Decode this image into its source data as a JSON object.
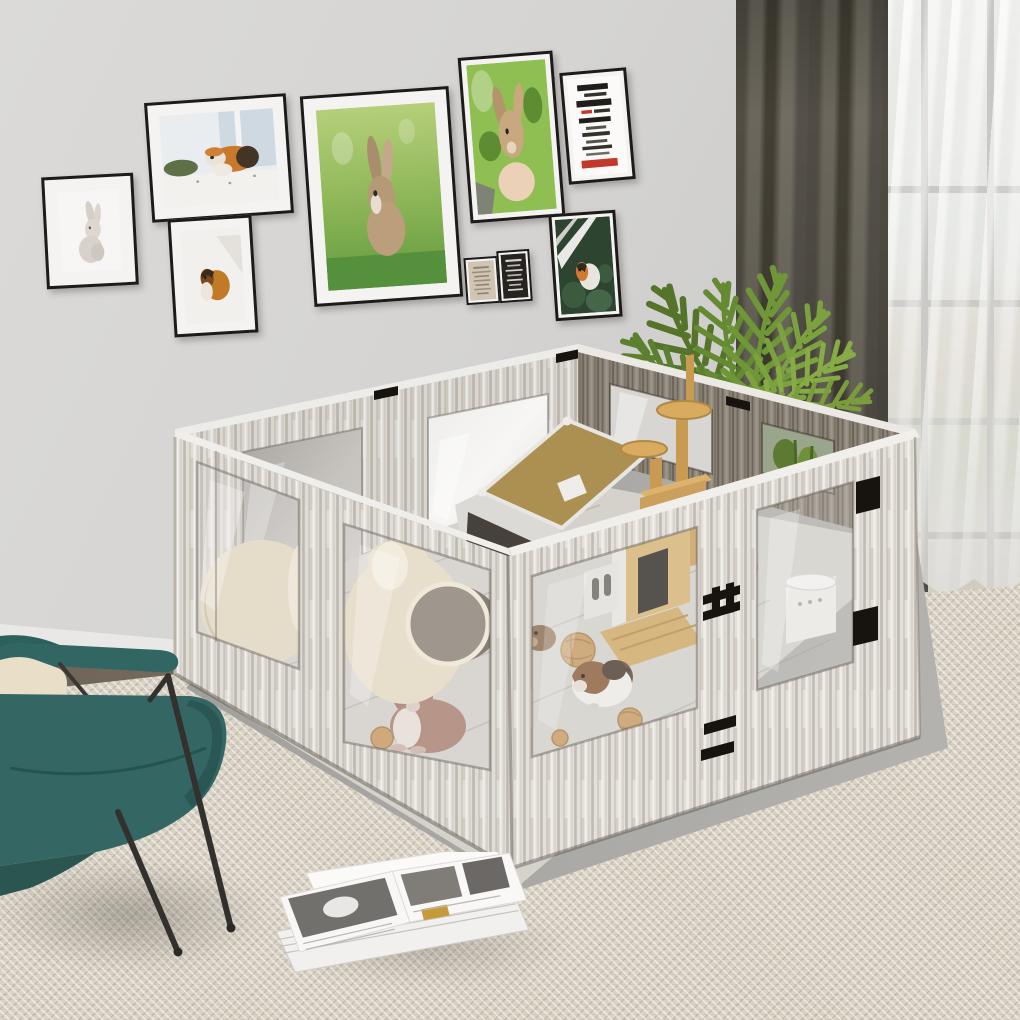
{
  "meta": {
    "type": "lifestyle product photograph",
    "description": "Large DIY small-animal playpen with white-washed wood panels and clear acrylic windows, set in a modern living room with a rabbit and guinea pigs inside",
    "image_width": 1020,
    "image_height": 1020
  },
  "palette": {
    "wall": "#d4d3d1",
    "baseboard": "#e9e8e6",
    "wood_floor_strip": "#7a6e5f",
    "carpet_beige": "#d9d2c5",
    "floor_mat_gray": "#a6a4a0",
    "pen_wood_light": "#e0dcd6",
    "pen_wood_dark": "#8f867a",
    "pen_top_edge": "#f0eeea",
    "acrylic_tint": "#c9c6c2",
    "hardware_black": "#17140f",
    "curtain_dark_olive": "#5a564c",
    "curtain_sheer_white": "#eceae7",
    "plant_green": "#6f9738",
    "chair_teal": "#346763",
    "pillow_cream": "#e9dfc8",
    "ceramic_cream": "#e6dcc6",
    "house_roof_khaki": "#ab9052",
    "climb_tree_wood": "#caa05c",
    "ball_tan": "#c99a62",
    "frame_black": "#1c1b1a"
  },
  "gallery": {
    "frames": [
      {
        "id": "frame-white-rabbit",
        "subject": "white rabbit art print"
      },
      {
        "id": "frame-guinea-pig-windowsill",
        "subject": "guinea pig on windowsill photo"
      },
      {
        "id": "frame-brown-guinea-pig",
        "subject": "brown guinea pig photo"
      },
      {
        "id": "frame-bunny-grass",
        "subject": "brown bunny on green grass photo"
      },
      {
        "id": "frame-rabbit-held",
        "subject": "rabbit held in hand photo"
      },
      {
        "id": "frame-typography",
        "subject": "black and red typography poster"
      },
      {
        "id": "frame-mini-beige",
        "subject": "small beige text print"
      },
      {
        "id": "frame-mini-black",
        "subject": "small black text print"
      },
      {
        "id": "frame-guinea-pig-leaves",
        "subject": "guinea pig among dark leaves photo"
      }
    ]
  },
  "right_side": {
    "curtain": "dark olive blackout curtain",
    "sheer": "white sheer curtain",
    "window": "bright window with garden view",
    "plant": "tall potted areca palm"
  },
  "enclosure": {
    "type": "small animal playpen / enclosure",
    "material": "white-washed wood-grain panels",
    "window_material": "clear acrylic",
    "hardware": [
      "black hinges",
      "black latch",
      "black vent slots"
    ],
    "contents": [
      "A-frame pet house with khaki roof",
      "wooden climbing tree with two round platforms",
      "ceramic dome hideout",
      "ceramic jar hideout with round opening",
      "white food container",
      "woven seagrass balls",
      "wooden floor ramp",
      "white divider with pill-shaped openings",
      "wooden doorway partition"
    ]
  },
  "animals": [
    {
      "type": "rabbit",
      "color": "brown with white chest",
      "location": "front-left window"
    },
    {
      "type": "guinea pig",
      "color": "white, brown and black",
      "location": "front-right window"
    },
    {
      "type": "guinea pig",
      "color": "brown",
      "location": "behind left acrylic pane"
    }
  ],
  "foreground": {
    "chair": "teal lounge chair with dark metal legs",
    "pillow": "cream cushion",
    "magazines": "open magazine stack lying on the rug",
    "carpet": "beige woven area rug"
  }
}
